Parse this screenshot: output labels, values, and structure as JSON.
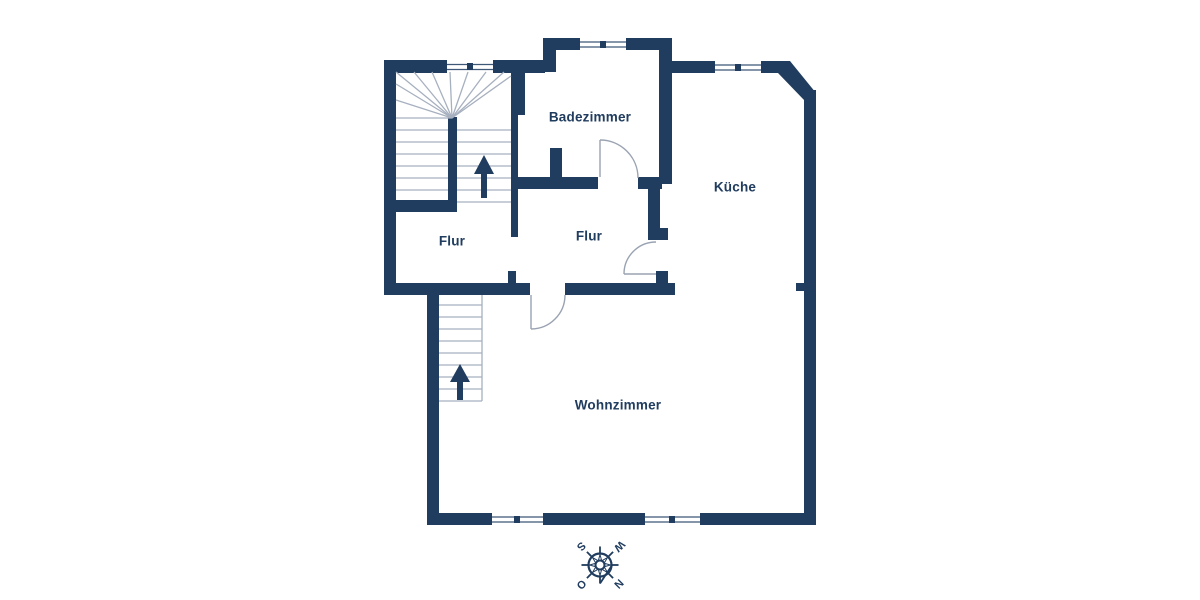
{
  "plan": {
    "type": "floor-plan",
    "rooms": [
      {
        "label": "Badezimmer"
      },
      {
        "label": "Küche"
      },
      {
        "label": "Flur"
      },
      {
        "label": "Flur"
      },
      {
        "label": "Wohnzimmer"
      }
    ],
    "stairs": [
      {
        "location": "upper-left",
        "direction_icon": "up-arrow"
      },
      {
        "location": "lower-left",
        "direction_icon": "up-arrow"
      }
    ],
    "windows_count": 5,
    "doors_count": 3
  },
  "compass": {
    "icon": "compass-rose",
    "rotation_deg": 135,
    "north": "N",
    "east": "O",
    "south": "S",
    "west": "W"
  },
  "colors": {
    "wall": "#203c5e",
    "background": "#ffffff",
    "stair_line": "#a7b0bf",
    "door_swing": "#9aa3b2",
    "window_line": "#3f5878"
  }
}
